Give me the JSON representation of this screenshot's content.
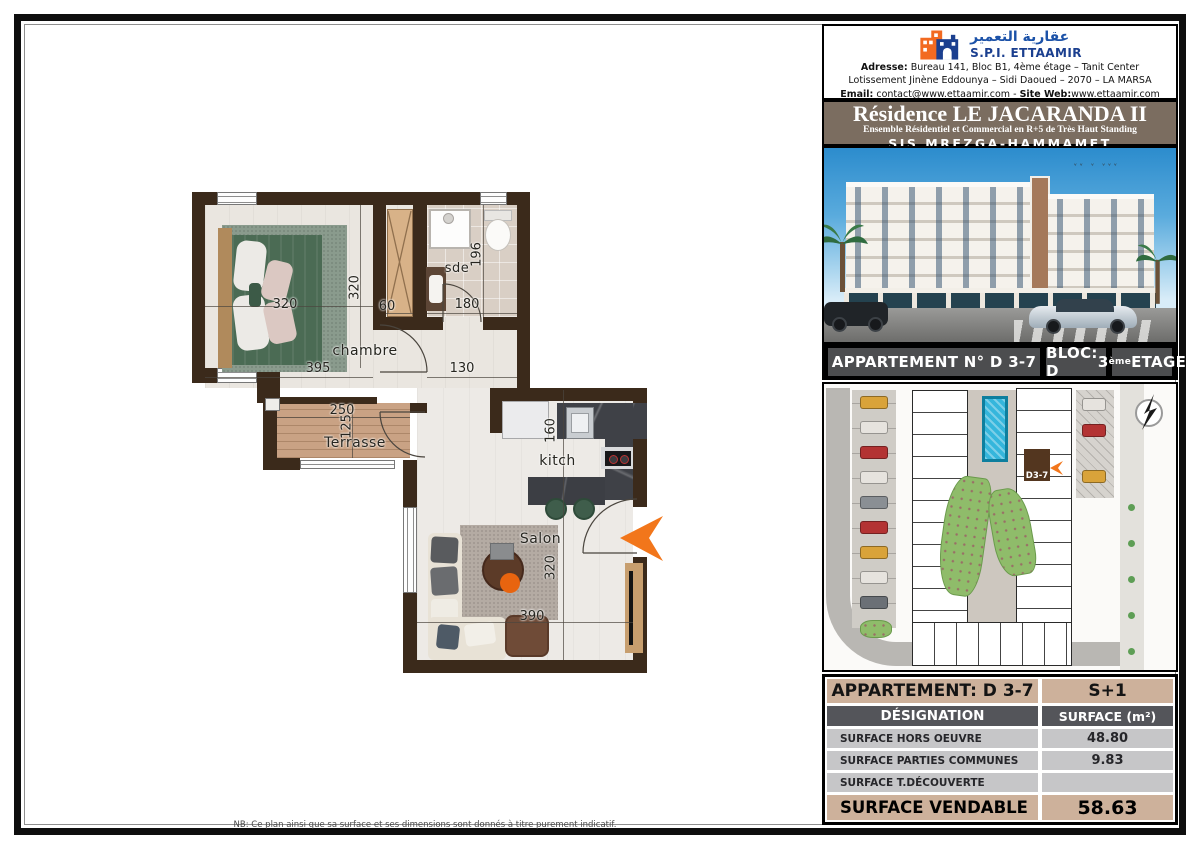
{
  "company": {
    "name_ar": "عقارية التعمير",
    "name_latin": "S.P.I. ETTAAMIR",
    "address_label": "Adresse:",
    "address_line1": "Bureau 141, Bloc B1, 4ème étage – Tanit Center",
    "address_line2": "Lotissement Jinène Eddounya – Sidi Daoued – 2070 – LA MARSA",
    "email_label": "Email:",
    "email": "contact@www.ettaamir.com",
    "separator": "-",
    "site_label": "Site Web:",
    "site": "www.ettaamir.com"
  },
  "residence": {
    "title": "Résidence LE JACARANDA II",
    "subtitle": "Ensemble Résidentiel et Commercial en R+5 de Très Haut Standing",
    "location": "SIS MREZGA-HAMMAMET"
  },
  "unit_bar": {
    "apartment": "APPARTEMENT N° D 3-7",
    "bloc": "BLOC: D",
    "floor_number": "3",
    "floor_ordinal": "ème",
    "floor_text": " ETAGE"
  },
  "site_plan": {
    "unit_marker": "D3-7"
  },
  "floor_plan": {
    "labels": {
      "bedroom": "chambre",
      "bathroom": "sde",
      "terrace": "Terrasse",
      "kitchen": "kitch",
      "living": "Salon"
    },
    "dimensions": {
      "bed_width": "320",
      "bedroom_depth": "320",
      "bedroom_width": "395",
      "closet_width": "60",
      "bathroom_depth": "196",
      "bathroom_width": "180",
      "hall_width": "130",
      "terrace_width": "250",
      "terrace_depth": "125",
      "kitchen_depth": "160",
      "living_depth": "320",
      "living_width": "390"
    }
  },
  "surface_table": {
    "header_left": "APPARTEMENT: D 3-7",
    "header_right": "S+1",
    "col_designation": "DÉSIGNATION",
    "col_surface": "SURFACE (m²)",
    "rows": [
      {
        "label": "SURFACE HORS OEUVRE",
        "value": "48.80"
      },
      {
        "label": "SURFACE PARTIES COMMUNES",
        "value": "9.83"
      },
      {
        "label": "SURFACE T.DÉCOUVERTE",
        "value": ""
      }
    ],
    "total_label": "SURFACE VENDABLE",
    "total_value": "58.63"
  },
  "footer": {
    "note": "NB: Ce plan ainsi que sa surface et ses dimensions sont donnés à titre purement indicatif."
  },
  "colors": {
    "wall_brown": "#3b2a1b",
    "entry_arrow_orange": "#f2761b",
    "banner_brown": "#7b6d60",
    "table_tan": "#cdb19b",
    "table_header_gray": "#54555a",
    "table_row_gray": "#c6c6c8",
    "logo_blue": "#1b3f8f",
    "logo_orange": "#f26a21"
  }
}
